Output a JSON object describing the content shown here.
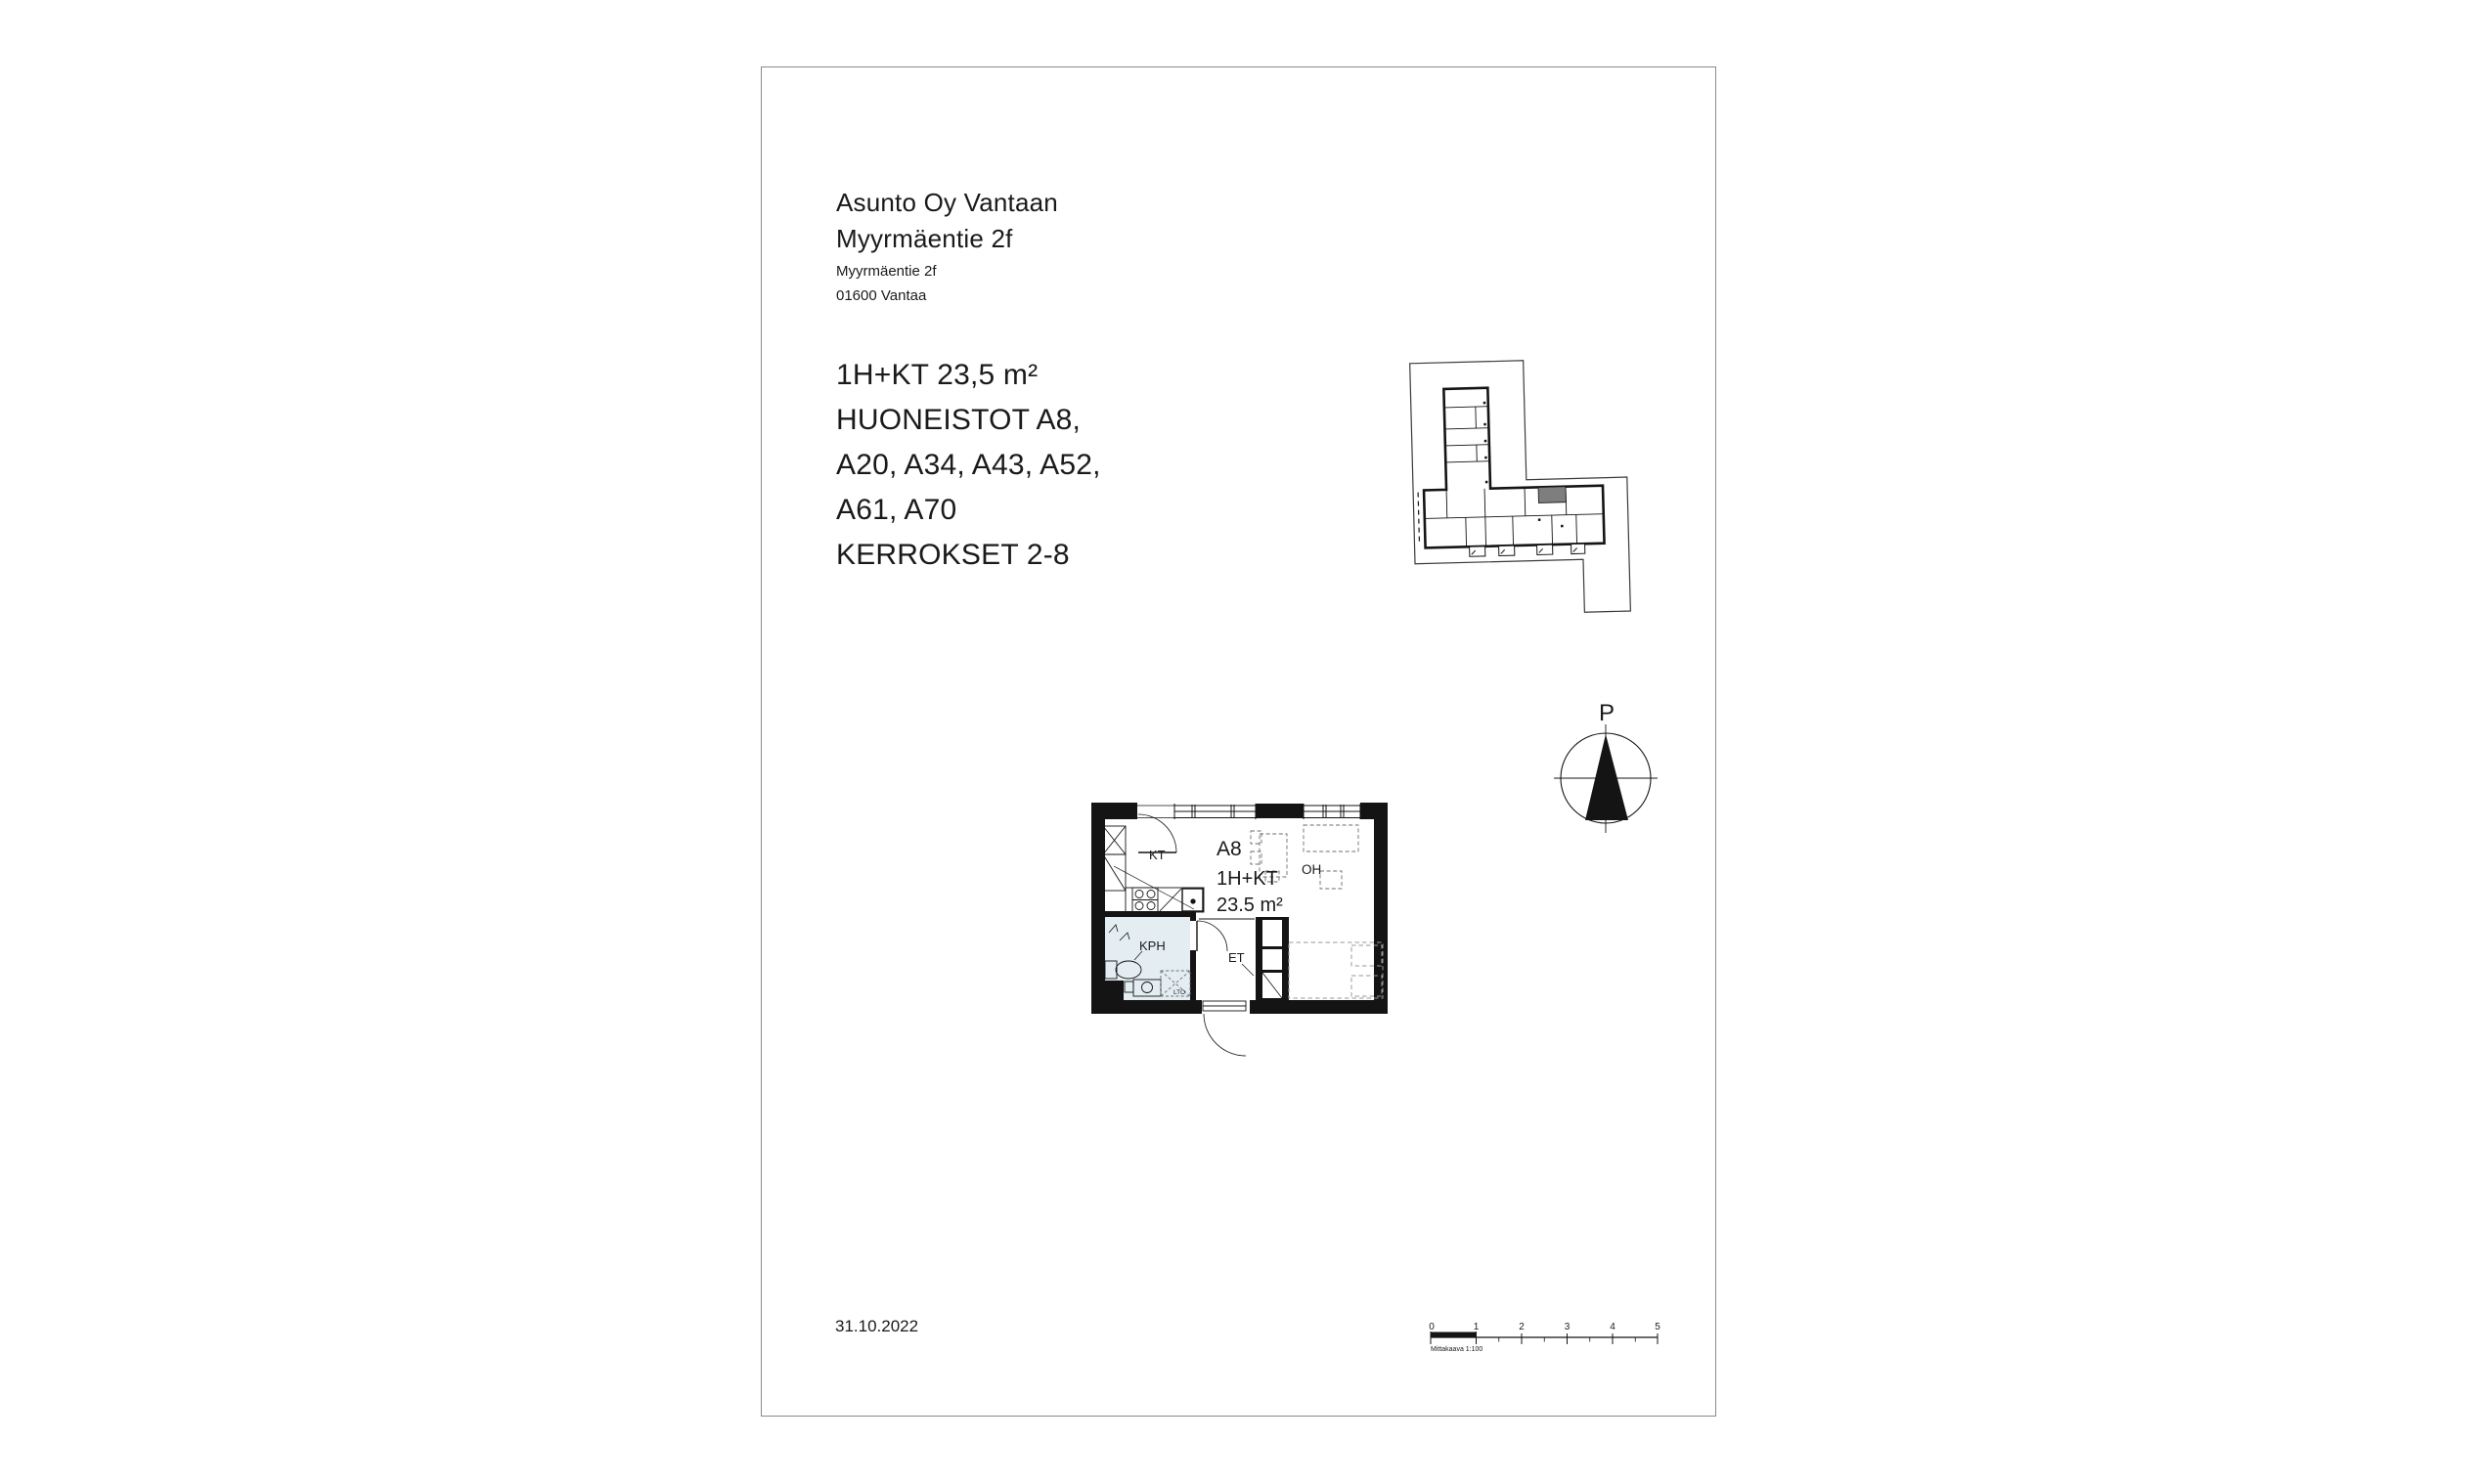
{
  "header": {
    "company_line1": "Asunto Oy Vantaan",
    "company_line2": "Myyrmäentie 2f",
    "address_line1": "Myyrmäentie 2f",
    "address_line2": "01600 Vantaa"
  },
  "apartment_info": {
    "lines": [
      "1H+KT 23,5 m²",
      "HUONEISTOT A8,",
      "A20, A34, A43, A52,",
      "A61, A70",
      "KERROKSET 2-8"
    ]
  },
  "floorplan": {
    "unit_id": "A8",
    "unit_type": "1H+KT",
    "unit_area": "23.5 m²",
    "room_labels": {
      "kitchen": "KT",
      "living": "OH",
      "bathroom": "KPH",
      "entry": "ET",
      "closet": "LTO"
    }
  },
  "north_arrow": {
    "label": "P"
  },
  "footer": {
    "date": "31.10.2022"
  },
  "scalebar": {
    "numbers": [
      "0",
      "1",
      "2",
      "3",
      "4",
      "5"
    ],
    "label": "Mittakaava 1:100"
  },
  "colors": {
    "wall": "#141414",
    "bathroom_fill": "#e4eef2",
    "highlighted_unit": "#7e7e7e",
    "page_border": "#8a8a8a",
    "furniture_dash": "#6e6e6e",
    "bed_dash": "#9a9a9a",
    "site_boundary": "#3a3a3a"
  }
}
